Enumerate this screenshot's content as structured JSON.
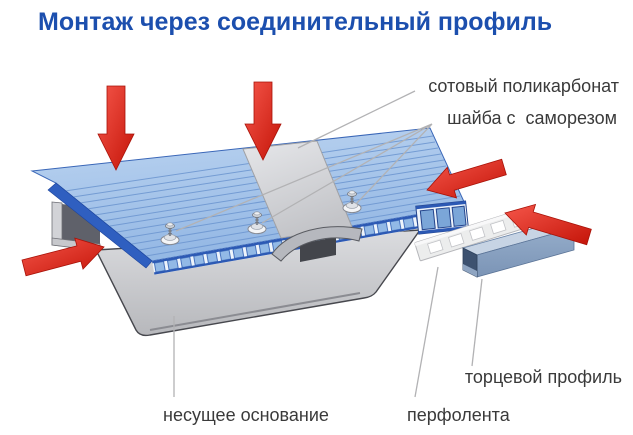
{
  "title": {
    "text": "Монтаж через соединительный профиль"
  },
  "labels": {
    "polycarbonate": "сотовый поликарбонат",
    "washer_screw": "шайба с  саморезом",
    "end_profile": "торцевой профиль",
    "perforated_tape": "перфолента",
    "base": "несущее основание"
  },
  "diagram": {
    "parts": [
      {
        "name": "polycarbonate-panel",
        "label": "сотовый поликарбонат"
      },
      {
        "name": "screw-with-washer",
        "label": "шайба с  саморезом",
        "count": 3
      },
      {
        "name": "connector-profile",
        "label": "соединительный профиль"
      },
      {
        "name": "base-channel",
        "label": "несущее основание"
      },
      {
        "name": "perforated-tape",
        "label": "перфолента"
      },
      {
        "name": "end-profile",
        "label": "торцевой профиль"
      }
    ],
    "arrow_icons": [
      {
        "name": "down-arrow-icon",
        "count": 2
      },
      {
        "name": "right-arrow-icon",
        "count": 1
      },
      {
        "name": "left-arrow-icon",
        "count": 2
      }
    ],
    "colors": {
      "title_blue": "#1c4fae",
      "panel_blue": "#a9c8ec",
      "panel_edge_blue": "#2f5fc0",
      "cell_blue": "#92b9e6",
      "profile_gray": "#c9cacd",
      "base_gray": "#c6c7cb",
      "end_profile_blue": "#8aa3c2",
      "arrow_red": "#e8271b",
      "leader_gray": "#b2b2b4",
      "label_text": "#3a3a3a",
      "background": "#ffffff"
    }
  }
}
